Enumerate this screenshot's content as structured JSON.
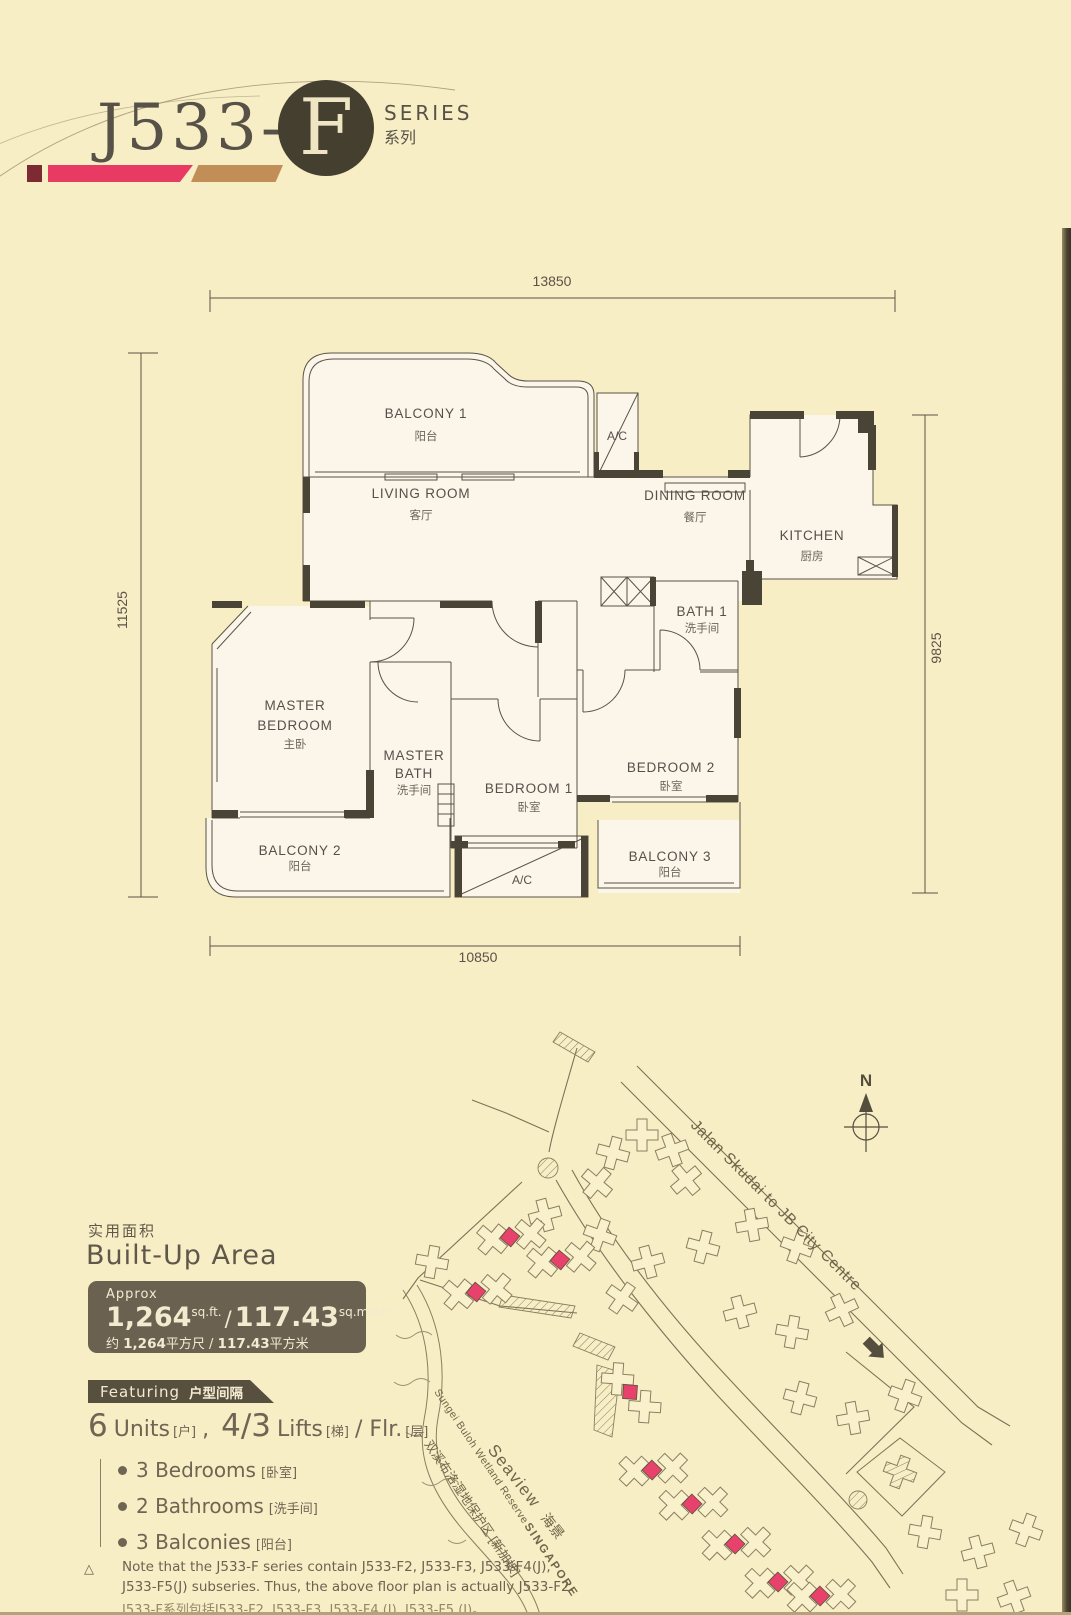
{
  "colors": {
    "bg": "#f8eec5",
    "accent_pink": "#e93a63",
    "accent_maroon": "#7d2a33",
    "accent_tan": "#c28e58",
    "wall": "#4a4436",
    "panel": "#6a6150",
    "map_pink": "#e8416b"
  },
  "header": {
    "model": "J533-",
    "variant": "F",
    "series_en": "SERIES",
    "series_zh": "系列"
  },
  "plan": {
    "dim_top": "13850",
    "dim_left": "11525",
    "dim_right": "9825",
    "dim_bottom": "10850",
    "balcony1": "BALCONY 1",
    "balcony1_zh": "阳台",
    "balcony2": "BALCONY 2",
    "balcony2_zh": "阳台",
    "balcony3": "BALCONY 3",
    "balcony3_zh": "阳台",
    "ac": "A/C",
    "living": "LIVING ROOM",
    "living_zh": "客厅",
    "dining": "DINING ROOM",
    "dining_zh": "餐厅",
    "kitchen": "KITCHEN",
    "kitchen_zh": "厨房",
    "bath1": "BATH 1",
    "bath1_zh": "洗手间",
    "master1": "MASTER",
    "master2": "BEDROOM",
    "master_zh": "主卧",
    "mbath1": "MASTER",
    "mbath2": "BATH",
    "mbath_zh": "洗手间",
    "bed1": "BEDROOM 1",
    "bed1_zh": "卧室",
    "bed2": "BEDROOM 2",
    "bed2_zh": "卧室"
  },
  "area": {
    "title_zh": "实用面积",
    "title_en": "Built-Up Area",
    "approx": "Approx",
    "sqft": "1,264",
    "sqft_unit": "sq.ft.",
    "slash": "/",
    "sqm": "117.43",
    "sqm_unit": "sq.meter",
    "zh_approx": "约",
    "zh_sqft": "1,264",
    "zh_sqft_unit": "平方尺",
    "zh_slash": "/",
    "zh_sqm": "117.43",
    "zh_sqm_unit": "平方米"
  },
  "featuring": {
    "label_en": "Featuring",
    "label_zh": "户型间隔",
    "units_num": "6",
    "units_word": "Units",
    "units_zh": "[户]",
    "sep": ",",
    "lifts_num": "4/3",
    "lifts_word": "Lifts",
    "lifts_zh": "[梯]",
    "flr_word": "/ Flr.",
    "flr_zh": "[层]",
    "bullets": [
      {
        "en": "3 Bedrooms",
        "zh": "[卧室]"
      },
      {
        "en": "2 Bathrooms",
        "zh": "[洗手间]"
      },
      {
        "en": "3 Balconies",
        "zh": "[阳台]"
      }
    ]
  },
  "note": {
    "mark": "△",
    "en1": "Note that the J533-F series contain J533-F2, J533-F3, J533-F4(J),",
    "en2": "J533-F5(J) subseries. Thus, the above floor plan is actually J533-F2.",
    "zh": "J533-F系列包括J533-F2, J533-F3, J533-F4 (J), J533-F5 (J)。"
  },
  "map": {
    "north": "N",
    "road": "Jalan Skudai to JB City Centre",
    "seaview_en": "Seaview",
    "seaview_zh": "海景",
    "reserve_en": "Sungei Buloh Wetland Reserve",
    "reserve_zh": "双溪布洛湿地保护区 [新加坡]",
    "country": "SINGAPORE"
  }
}
